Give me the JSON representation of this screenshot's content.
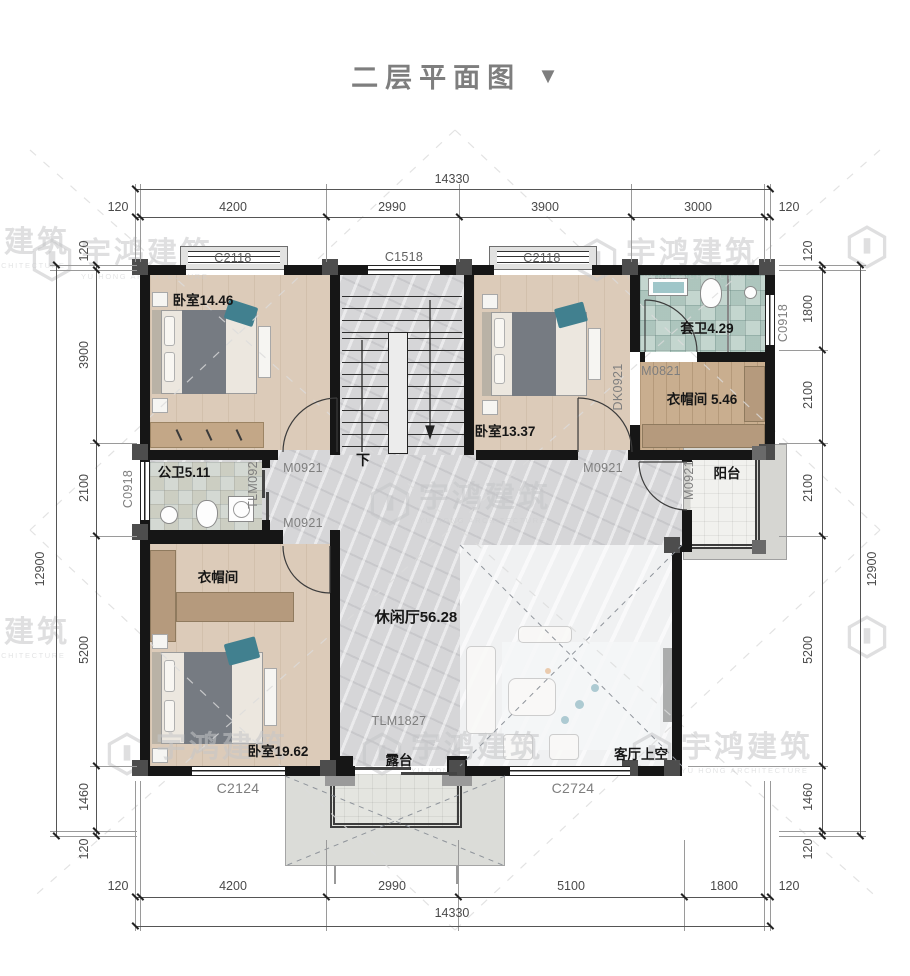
{
  "title": {
    "text": "二层平面图",
    "arrow": "▼"
  },
  "brand": {
    "cn": "宇鸿建筑",
    "en": "YU HONG ARCHITECTURE"
  },
  "dims": {
    "top": {
      "overall": "14330",
      "s": [
        "120",
        "4200",
        "2990",
        "3900",
        "3000",
        "120"
      ]
    },
    "bottom": {
      "overall": "14330",
      "s": [
        "120",
        "4200",
        "2990",
        "5100",
        "1800",
        "120"
      ]
    },
    "left": {
      "overall": "12900",
      "s": [
        "120",
        "3900",
        "2100",
        "5200",
        "1460",
        "120"
      ]
    },
    "right": {
      "overall": "12900",
      "s": [
        "120",
        "1800",
        "2100",
        "2100",
        "5200",
        "1460",
        "120"
      ]
    }
  },
  "rooms": {
    "bedroom_tl": "卧室14.46",
    "bedroom_tr": "卧室13.37",
    "bedroom_master": "卧室19.62",
    "ensuite": "套卫4.29",
    "closet_right": "衣帽间 5.46",
    "closet_master": "衣帽间",
    "bath": "公卫5.11",
    "lounge": "休闲厅56.28",
    "balcony": "阳台",
    "terrace": "露台",
    "void": "客厅上空",
    "stair_down": "下"
  },
  "openings": {
    "c2118_a": "C2118",
    "c1518": "C1518",
    "c2118_b": "C2118",
    "c0918_l": "C0918",
    "c0918_r": "C0918",
    "m0821": "M0821",
    "dk0921": "DK0921",
    "m0921_bed_tl": "M0921",
    "m0921_bed_tr": "M0921",
    "m0921_master": "M0921",
    "m0921_balcony": "M0921",
    "tlm0921": "TLM092",
    "tlm1827": "TLM1827",
    "c2124": "C2124",
    "c2724": "C2724"
  }
}
